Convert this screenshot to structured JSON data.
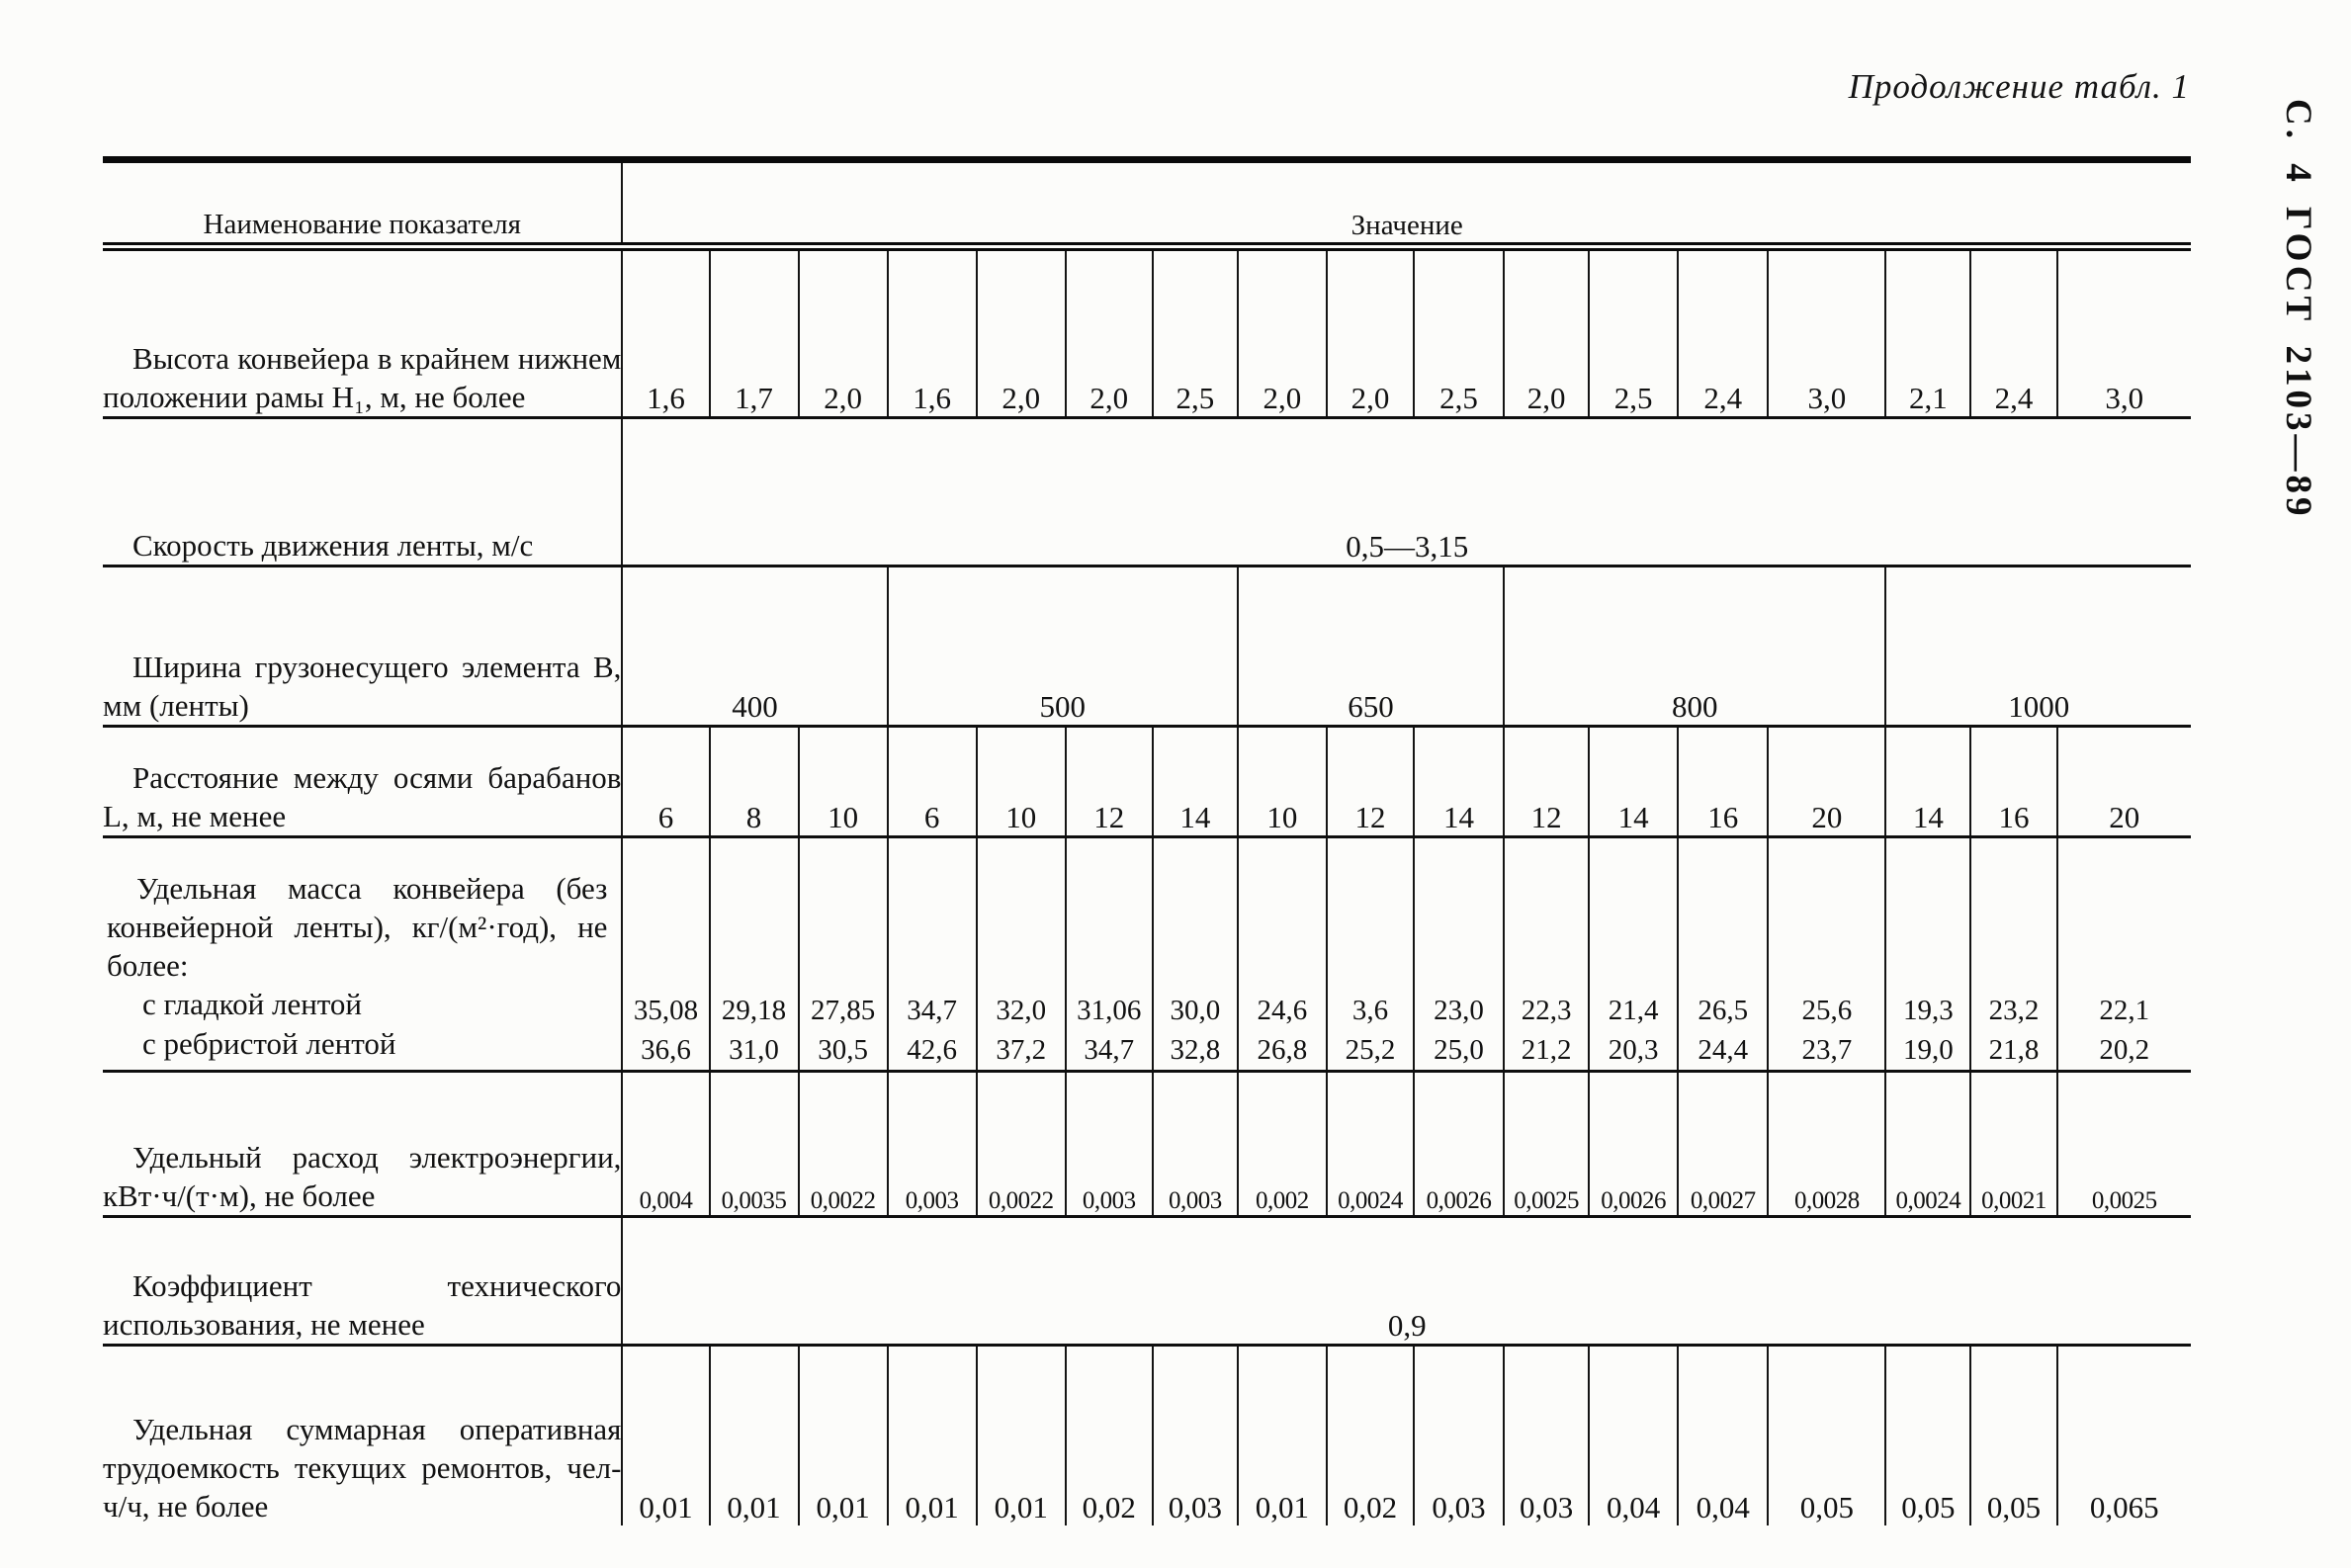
{
  "page": {
    "continuation": "Продолжение табл. 1",
    "side_note": "С. 4 ГОСТ 2103—89"
  },
  "table": {
    "header": {
      "name_col": "Наименование показателя",
      "value_col": "Значение"
    },
    "rows": [
      {
        "type": "cells",
        "label": "Высота конвейера в крайнем нижнем положении рамы H₁, м, не более",
        "values": [
          "1,6",
          "1,7",
          "2,0",
          "1,6",
          "2,0",
          "2,0",
          "2,5",
          "2,0",
          "2,0",
          "2,5",
          "2,0",
          "2,5",
          "2,4",
          "3,0",
          "2,1",
          "2,4",
          "3,0"
        ]
      },
      {
        "type": "span",
        "label": "Скорость движения ленты, м/с",
        "value": "0,5—3,15"
      },
      {
        "type": "groups",
        "label": "Ширина грузонесущего элемента B, мм (ленты)",
        "groups": [
          {
            "value": "400",
            "span": 3
          },
          {
            "value": "500",
            "span": 4
          },
          {
            "value": "650",
            "span": 3
          },
          {
            "value": "800",
            "span": 4
          },
          {
            "value": "1000",
            "span": 3
          }
        ]
      },
      {
        "type": "cells",
        "label": "Расстояние между осями барабанов L, м, не менее",
        "values": [
          "6",
          "8",
          "10",
          "6",
          "10",
          "12",
          "14",
          "10",
          "12",
          "14",
          "12",
          "14",
          "16",
          "20",
          "14",
          "16",
          "20"
        ]
      },
      {
        "type": "two-line",
        "label": "Удельная масса конвейера (без конвейерной ленты), кг/(м²·год), не более:",
        "sub_labels": [
          "с гладкой лентой",
          "с ребристой лентой"
        ],
        "values_top": [
          "35,08",
          "29,18",
          "27,85",
          "34,7",
          "32,0",
          "31,06",
          "30,0",
          "24,6",
          "3,6",
          "23,0",
          "22,3",
          "21,4",
          "26,5",
          "25,6",
          "19,3",
          "23,2",
          "22,1"
        ],
        "values_bottom": [
          "36,6",
          "31,0",
          "30,5",
          "42,6",
          "37,2",
          "34,7",
          "32,8",
          "26,8",
          "25,2",
          "25,0",
          "21,2",
          "20,3",
          "24,4",
          "23,7",
          "19,0",
          "21,8",
          "20,2"
        ]
      },
      {
        "type": "cells",
        "small": true,
        "label": "Удельный расход электроэнергии, кВт·ч/(т·м), не более",
        "values": [
          "0,004",
          "0,0035",
          "0,0022",
          "0,003",
          "0,0022",
          "0,003",
          "0,003",
          "0,002",
          "0,0024",
          "0,0026",
          "0,0025",
          "0,0026",
          "0,0027",
          "0,0028",
          "0,0024",
          "0,0021",
          "0,0025"
        ]
      },
      {
        "type": "span",
        "label": "Коэффициент технического использования, не менее",
        "value": "0,9"
      },
      {
        "type": "cells",
        "label": "Удельная суммарная оперативная трудоемкость текущих ремонтов, чел-ч/ч, не более",
        "values": [
          "0,01",
          "0,01",
          "0,01",
          "0,01",
          "0,01",
          "0,02",
          "0,03",
          "0,01",
          "0,02",
          "0,03",
          "0,03",
          "0,04",
          "0,04",
          "0,05",
          "0,05",
          "0,05",
          "0,065"
        ]
      }
    ]
  }
}
